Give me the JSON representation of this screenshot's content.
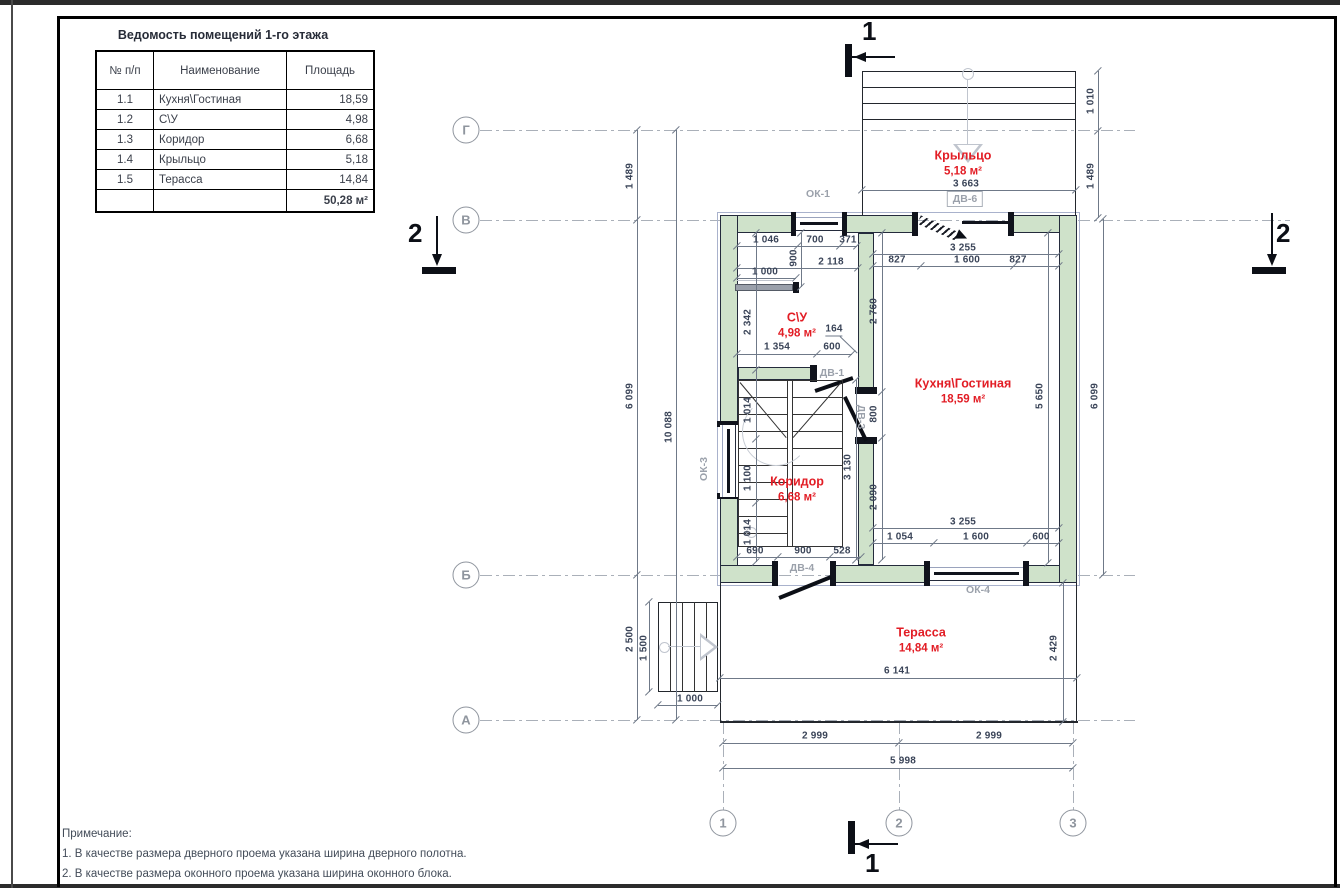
{
  "schedule": {
    "title": "Ведомость помещений 1-го этажа",
    "columns": [
      "№ п/п",
      "Наименование",
      "Площадь"
    ],
    "rows": [
      [
        "1.1",
        "Кухня\\Гостиная",
        "18,59"
      ],
      [
        "1.2",
        "С\\У",
        "4,98"
      ],
      [
        "1.3",
        "Коридор",
        "6,68"
      ],
      [
        "1.4",
        "Крыльцо",
        "5,18"
      ],
      [
        "1.5",
        "Терасса",
        "14,84"
      ]
    ],
    "total": "50,28 м²"
  },
  "rooms": [
    {
      "name": "Крыльцо",
      "area": "5,18 м²",
      "x": 963,
      "y": 163
    },
    {
      "name": "Кухня\\Гостиная",
      "area": "18,59 м²",
      "x": 963,
      "y": 391
    },
    {
      "name": "С\\У",
      "area": "4,98 м²",
      "x": 797,
      "y": 325
    },
    {
      "name": "Коридор",
      "area": "6,68 м²",
      "x": 797,
      "y": 489
    },
    {
      "name": "Терасса",
      "area": "14,84 м²",
      "x": 921,
      "y": 640
    }
  ],
  "grid": {
    "rows": [
      {
        "label": "Г",
        "x": 466,
        "y": 130
      },
      {
        "label": "В",
        "x": 466,
        "y": 220
      },
      {
        "label": "Б",
        "x": 466,
        "y": 575
      },
      {
        "label": "А",
        "x": 466,
        "y": 720
      }
    ],
    "cols": [
      {
        "label": "1",
        "x": 723,
        "y": 823
      },
      {
        "label": "2",
        "x": 899,
        "y": 823
      },
      {
        "label": "3",
        "x": 1073,
        "y": 823
      }
    ]
  },
  "openings": [
    {
      "label": "ОК-1",
      "x": 818,
      "y": 194,
      "rot": 0,
      "boxed": false
    },
    {
      "label": "ДВ-6",
      "x": 965,
      "y": 199,
      "rot": 0,
      "boxed": true
    },
    {
      "label": "ОК-3",
      "x": 704,
      "y": 469,
      "rot": -90,
      "boxed": false
    },
    {
      "label": "ДВ-1",
      "x": 832,
      "y": 373,
      "rot": 0,
      "boxed": false
    },
    {
      "label": "ДВ-3",
      "x": 861,
      "y": 417,
      "rot": 90,
      "boxed": false
    },
    {
      "label": "ДВ-4",
      "x": 802,
      "y": 568,
      "rot": 0,
      "boxed": false
    },
    {
      "label": "ОК-4",
      "x": 978,
      "y": 590,
      "rot": 0,
      "boxed": false
    }
  ],
  "dims": [
    {
      "t": "1 046",
      "x": 766,
      "y": 240
    },
    {
      "t": "700",
      "x": 815,
      "y": 240
    },
    {
      "t": "371",
      "x": 848,
      "y": 240
    },
    {
      "t": "900",
      "x": 794,
      "y": 258,
      "rot": -90
    },
    {
      "t": "2 118",
      "x": 831,
      "y": 262
    },
    {
      "t": "1 000",
      "x": 765,
      "y": 272
    },
    {
      "t": "3 255",
      "x": 963,
      "y": 248
    },
    {
      "t": "827",
      "x": 897,
      "y": 260
    },
    {
      "t": "1 600",
      "x": 967,
      "y": 260
    },
    {
      "t": "827",
      "x": 1018,
      "y": 260
    },
    {
      "t": "2 342",
      "x": 748,
      "y": 322,
      "rot": -90
    },
    {
      "t": "164",
      "x": 834,
      "y": 330,
      "leader": true
    },
    {
      "t": "1 354",
      "x": 777,
      "y": 347
    },
    {
      "t": "600",
      "x": 832,
      "y": 347
    },
    {
      "t": "2 760",
      "x": 874,
      "y": 311,
      "rot": -90
    },
    {
      "t": "800",
      "x": 874,
      "y": 414,
      "rot": -90
    },
    {
      "t": "2 090",
      "x": 874,
      "y": 497,
      "rot": -90
    },
    {
      "t": "5 650",
      "x": 1040,
      "y": 396,
      "rot": -90
    },
    {
      "t": "6 099",
      "x": 1095,
      "y": 396,
      "rot": -90
    },
    {
      "t": "1 010",
      "x": 1091,
      "y": 101,
      "rot": -90
    },
    {
      "t": "1 489",
      "x": 1091,
      "y": 176,
      "rot": -90
    },
    {
      "t": "3 663",
      "x": 966,
      "y": 184
    },
    {
      "t": "1 014",
      "x": 748,
      "y": 410,
      "rot": -90
    },
    {
      "t": "1 100",
      "x": 748,
      "y": 478,
      "rot": -90
    },
    {
      "t": "1 014",
      "x": 748,
      "y": 532,
      "rot": -90
    },
    {
      "t": "3 130",
      "x": 848,
      "y": 467,
      "rot": -90
    },
    {
      "t": "690",
      "x": 755,
      "y": 551
    },
    {
      "t": "900",
      "x": 803,
      "y": 551
    },
    {
      "t": "528",
      "x": 842,
      "y": 551
    },
    {
      "t": "3 255",
      "x": 963,
      "y": 522
    },
    {
      "t": "1 054",
      "x": 900,
      "y": 537
    },
    {
      "t": "1 600",
      "x": 976,
      "y": 537
    },
    {
      "t": "600",
      "x": 1041,
      "y": 537
    },
    {
      "t": "6 141",
      "x": 897,
      "y": 671
    },
    {
      "t": "2 429",
      "x": 1054,
      "y": 648,
      "rot": -90
    },
    {
      "t": "1 500",
      "x": 644,
      "y": 648,
      "rot": -90
    },
    {
      "t": "1 000",
      "x": 690,
      "y": 699
    },
    {
      "t": "2 999",
      "x": 815,
      "y": 736
    },
    {
      "t": "2 999",
      "x": 989,
      "y": 736
    },
    {
      "t": "5 998",
      "x": 903,
      "y": 761
    },
    {
      "t": "1 489",
      "x": 630,
      "y": 176,
      "rot": -90
    },
    {
      "t": "6 099",
      "x": 630,
      "y": 396,
      "rot": -90
    },
    {
      "t": "2 500",
      "x": 630,
      "y": 639,
      "rot": -90
    },
    {
      "t": "10 088",
      "x": 669,
      "y": 427,
      "rot": -90
    }
  ],
  "sections": {
    "s1": "1",
    "s2": "2"
  },
  "notes": {
    "title": "Примечание:",
    "line1": "1. В качестве размера дверного проема указана ширина дверного полотна.",
    "line2": "2. В качестве размера оконного проема указана ширина оконного блока."
  },
  "colors": {
    "wall_fill": "#cfe2ca",
    "wall_line": "#242b3c",
    "accent_red": "#e21d25",
    "dim_text": "#3a4458",
    "dim_line": "#6f7988",
    "muted_label": "#9ba1ab",
    "grid_line": "#aab0b9"
  }
}
